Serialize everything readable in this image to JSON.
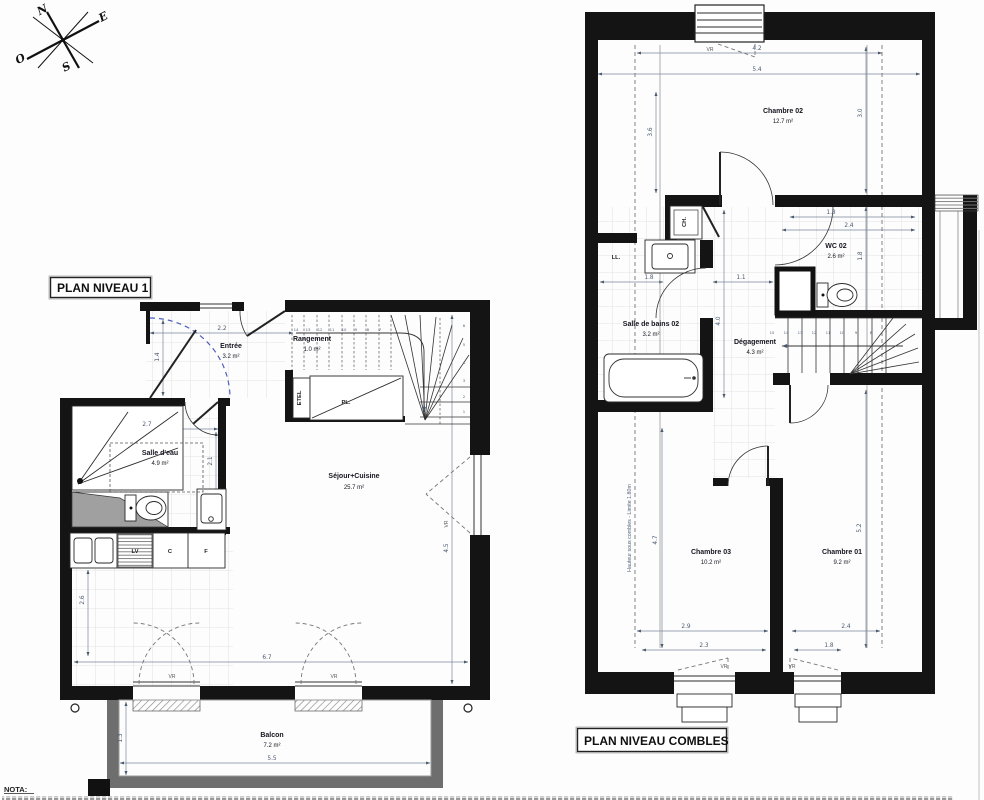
{
  "compass": {
    "north": "N",
    "east": "E",
    "west": "O",
    "south": "S"
  },
  "plan1": {
    "title": "PLAN NIVEAU 1",
    "rooms": {
      "entree": {
        "name": "Entrée",
        "area": "3.2 m²"
      },
      "rangement": {
        "name": "Rangement",
        "area": "1.0 m²"
      },
      "salle_deau": {
        "name": "Salle d'eau",
        "area": "4.9 m²"
      },
      "sejour_cuisine": {
        "name": "Séjour+Cuisine",
        "area": "25.7 m²"
      },
      "balcon": {
        "name": "Balcon",
        "area": "7.2 m²"
      }
    },
    "equipment": {
      "etel": "ETEL",
      "placard": "PL.",
      "lave_vaisselle": "LV",
      "cuisson": "C",
      "frigo": "F"
    },
    "shutters": {
      "window_right": "VR",
      "door_left": "VR",
      "door_right": "VR"
    },
    "dims": {
      "entree_w": "2.2",
      "entree_d": "1.4",
      "sde_w": "2.7",
      "sde_d": "2.1",
      "kitchen_d": "2.6",
      "sejour_w": "6.7",
      "sejour_d": "4.5",
      "balcon_w": "5.5",
      "balcon_d": "1.3"
    },
    "stairs": {
      "upper_steps": [
        "14",
        "13",
        "12",
        "11",
        "10",
        "9",
        "8",
        "7"
      ],
      "winder_steps": [
        "6",
        "5",
        "4",
        "3",
        "2",
        "1"
      ]
    }
  },
  "combles": {
    "title": "PLAN NIVEAU COMBLES",
    "rooms": {
      "chambre02": {
        "name": "Chambre 02",
        "area": "12.7 m²"
      },
      "wc02": {
        "name": "WC 02",
        "area": "2.6 m²"
      },
      "sdb02": {
        "name": "Salle de bains 02",
        "area": "3.2 m²"
      },
      "degagement": {
        "name": "Dégagement",
        "area": "4.3 m²"
      },
      "chambre03": {
        "name": "Chambre 03",
        "area": "10.2 m²"
      },
      "chambre01": {
        "name": "Chambre 01",
        "area": "9.2 m²"
      }
    },
    "equipment": {
      "chaudiere": "CH.",
      "lave_linge": "LL."
    },
    "shutters": {
      "window_top": "VR",
      "window_bottom_left": "VR",
      "window_bottom_right": "VR"
    },
    "note_sous_combles": "Hauteur sous combles - Limite 1.80m",
    "dims": {
      "ch02_w1": "4.2",
      "ch02_w2": "5.4",
      "ch02_h_left": "3.6",
      "ch02_h_right": "3.0",
      "nook_w": "1.8",
      "hall_w": "1.1",
      "wc_w1": "1.8",
      "wc_w2": "2.4",
      "wc_h": "1.8",
      "degagement_h": "4.0",
      "ch03_h": "4.7",
      "ch03_w1": "2.9",
      "ch03_w2": "2.3",
      "ch01_h": "5.2",
      "ch01_w1": "2.4",
      "ch01_w2": "1.8"
    },
    "stairs": {
      "steps": [
        "15",
        "14",
        "13",
        "12",
        "11",
        "10",
        "9",
        "8",
        "7"
      ]
    }
  },
  "footer": {
    "nota": "NOTA:"
  }
}
